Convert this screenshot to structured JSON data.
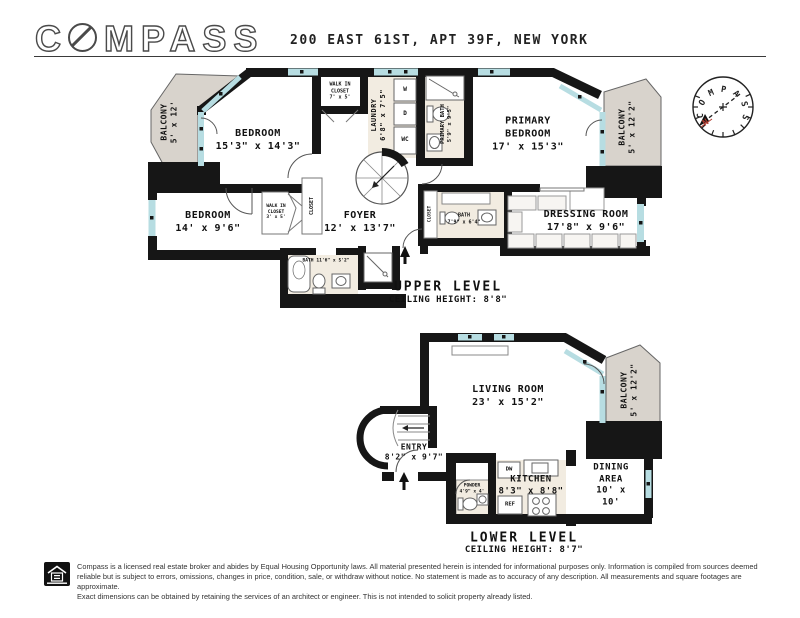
{
  "header": {
    "brand_c": "C",
    "brand_rest": "MPASS",
    "title": "200 EAST 61ST, APT 39F, NEW YORK"
  },
  "compass_rose": {
    "brand": "COMPASS",
    "north": "N"
  },
  "upper": {
    "level_title": "UPPER LEVEL",
    "ceiling": "CEILING HEIGHT: 8'8\"",
    "balcony_left": {
      "name": "BALCONY",
      "dims": "5' x 12'"
    },
    "bedroom1": {
      "name": "BEDROOM",
      "dims": "15'3\" x 14'3\""
    },
    "wic1": {
      "name": "WALK IN CLOSET",
      "dims": "7' x 5'"
    },
    "laundry": {
      "name": "LAUNDRY",
      "dims": "6'8\" x 7'5\""
    },
    "washer": "W",
    "dryer": "D",
    "wc": "WC",
    "primary_bath": {
      "name": "PRIMARY BATH",
      "dims": "5'9\" x 9'5\""
    },
    "primary_bedroom": {
      "name": "PRIMARY BEDROOM",
      "dims": "17' x 15'3\""
    },
    "balcony_right": {
      "name": "BALCONY",
      "dims": "5' x 12'2\""
    },
    "bedroom2": {
      "name": "BEDROOM",
      "dims": "14' x 9'6\""
    },
    "wic2": {
      "name": "WALK IN CLOSET",
      "dims": "3' x 5'"
    },
    "closet1": "CLOSET",
    "foyer": {
      "name": "FOYER",
      "dims": "12' x 13'7\""
    },
    "bath1": {
      "name": "BATH",
      "dims": "11'6\" x 5'2\""
    },
    "closet2": "CLOSET",
    "bath2": {
      "name": "BATH",
      "dims": "7'9\" x 6'4\""
    },
    "dressing": {
      "name": "DRESSING ROOM",
      "dims": "17'8\" x 9'6\""
    }
  },
  "lower": {
    "level_title": "LOWER LEVEL",
    "ceiling": "CEILING HEIGHT: 8'7\"",
    "living": {
      "name": "LIVING ROOM",
      "dims": "23' x 15'2\""
    },
    "balcony": {
      "name": "BALCONY",
      "dims": "5' x 12'2\""
    },
    "entry": {
      "name": "ENTRY",
      "dims": "8'2\" x 9'7\""
    },
    "powder": {
      "name": "POWDER",
      "dims": "4'9\" x 4'"
    },
    "kitchen": {
      "name": "KITCHEN",
      "dims": "8'3\" x 8'8\""
    },
    "dw": "DW",
    "ref": "REF",
    "dining": {
      "name": "DINING AREA",
      "dims": "10' x 10'"
    }
  },
  "colors": {
    "wall": "#161616",
    "window": "#b7dde2",
    "balcony_fill": "#d8d3cc",
    "wet_room_fill": "#f2ece1",
    "north_red": "#b03a2e"
  },
  "footer": {
    "lines": [
      "Compass is a licensed real estate broker and abides by Equal Housing Opportunity laws. All material presented herein is intended for informational purposes only. Information is compiled from sources deemed",
      "reliable but is subject to errors, omissions, changes in price, condition, sale, or withdraw without notice. No statement is made as to accuracy of any description. All measurements and square footages are approximate.",
      "Exact dimensions can be obtained by retaining the services of an architect or engineer. This is not intended to solicit property already listed."
    ]
  }
}
